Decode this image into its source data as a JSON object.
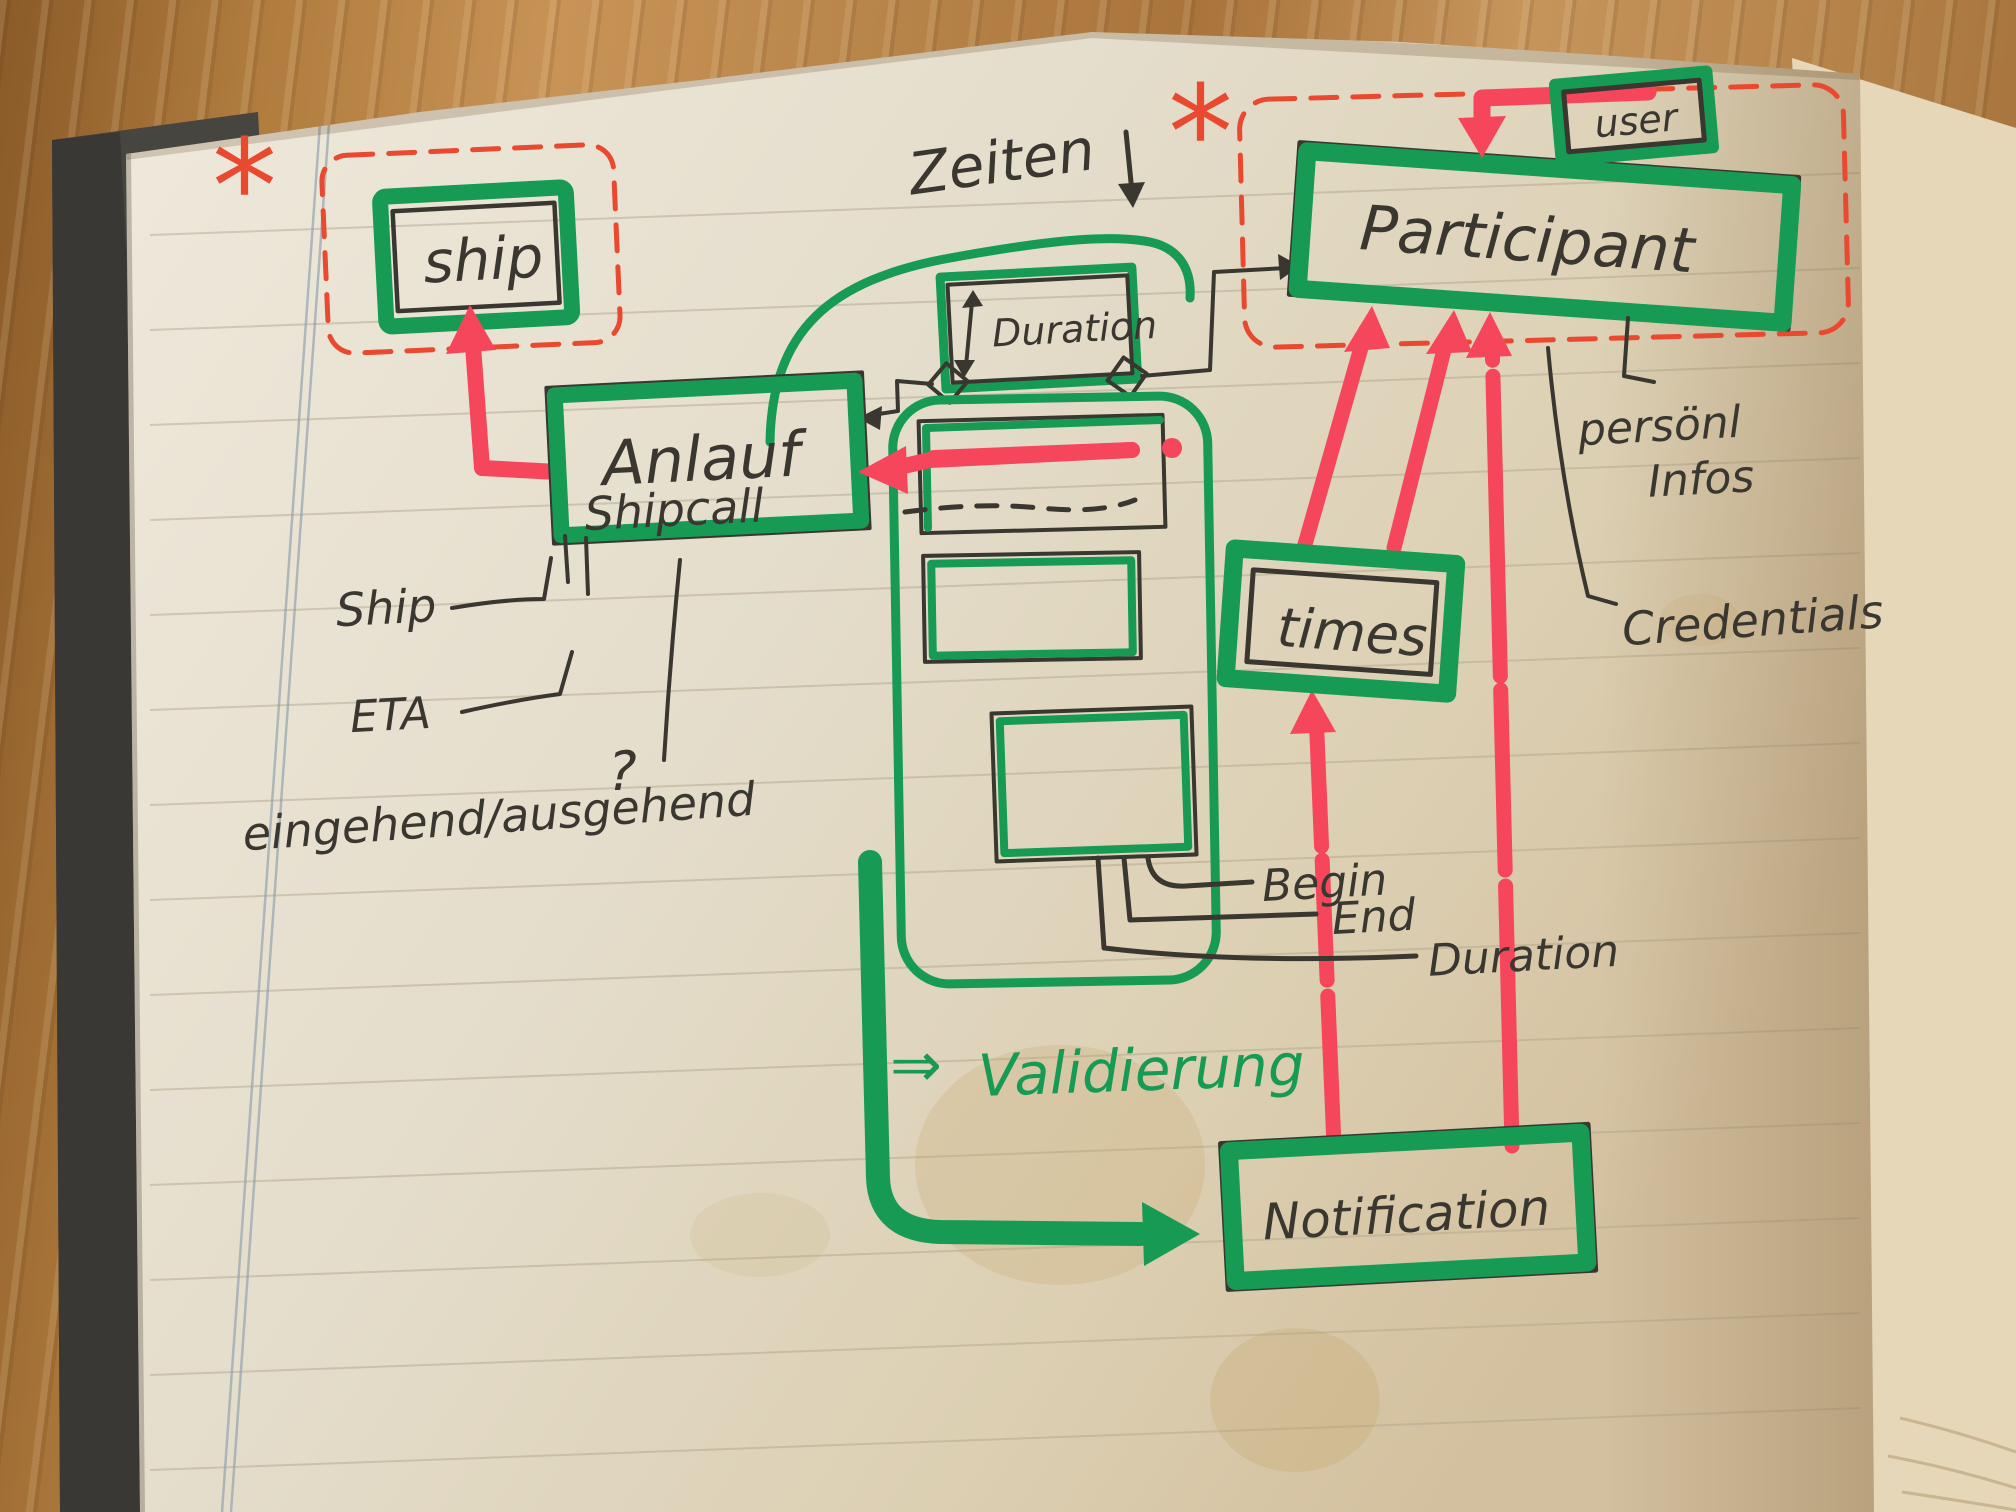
{
  "entities": {
    "ship": "ship",
    "anlauf_title": "Anlauf",
    "anlauf_subtitle": "Shipcall",
    "duration_box": "Duration",
    "participant": "Participant",
    "user": "user",
    "times": "times",
    "notification": "Notification"
  },
  "attributes": {
    "ship": "Ship",
    "eta": "ETA",
    "inout": "eingehend/ausgehend",
    "question_mark": "?",
    "begin": "Begin",
    "end": "End",
    "duration": "Duration",
    "personal_info_line1": "persönl",
    "personal_info_line2": "Infos",
    "credentials": "Credentials"
  },
  "notes": {
    "zeiten_label": "Zeiten",
    "validierung_arrow": "⇒",
    "validierung_label": "Validierung",
    "asterisk_ship": "*",
    "asterisk_participant": "*"
  },
  "colors": {
    "marker_green": "#179a54",
    "marker_red": "#f5465c",
    "pen_red": "#e8492f",
    "pen_black": "#3a3731",
    "paper": "#e6dfcf"
  }
}
